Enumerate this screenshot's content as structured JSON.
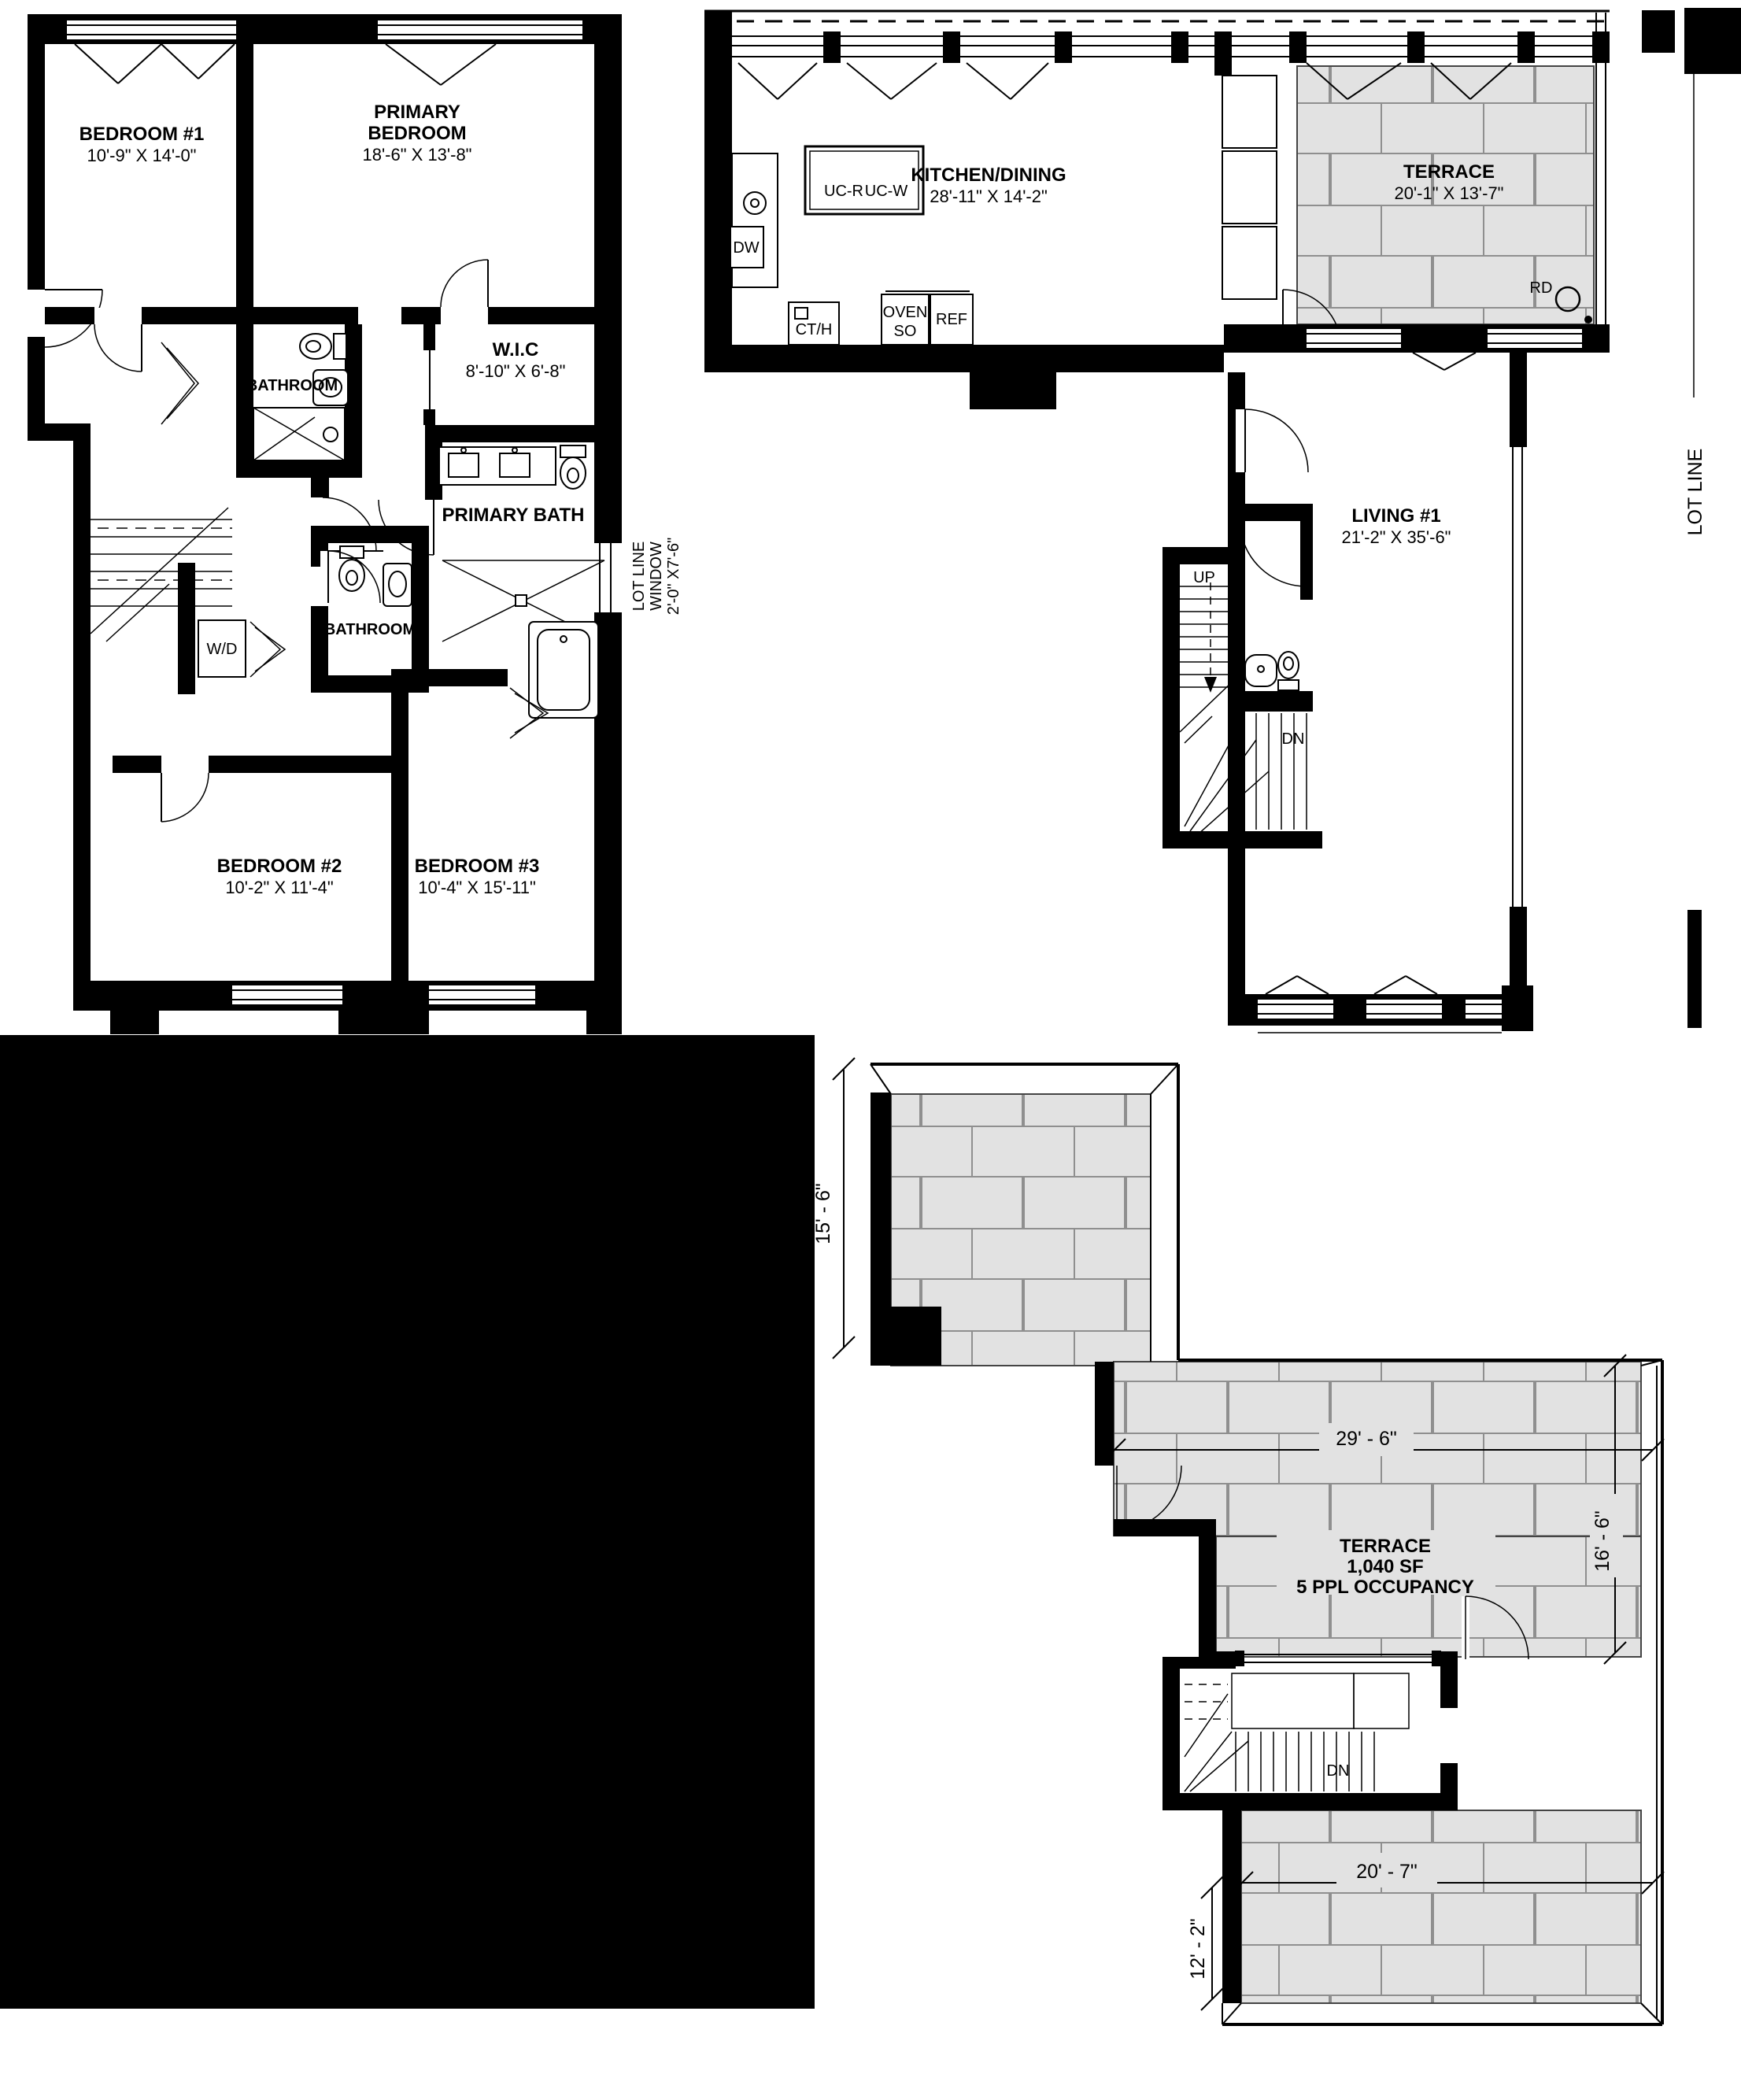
{
  "drawing_type": "residential floor plans, three sheets: bedroom level, main level, roof terrace",
  "colors": {
    "wall": "#000000",
    "tile_fill": "#e2e2e2",
    "tile_joint": "#8f8f8f",
    "background": "#ffffff"
  },
  "bedroom_level": {
    "bedroom1": {
      "name": "BEDROOM #1",
      "dims": "10'-9\" X 14'-0\""
    },
    "primary_bedroom": {
      "line1": "PRIMARY",
      "line2": "BEDROOM",
      "dims": "18'-6\" X 13'-8\""
    },
    "bathroom_upper": {
      "name": "BATHROOM"
    },
    "wic": {
      "name": "W.I.C",
      "dims": "8'-10\" X 6'-8\""
    },
    "primary_bath": {
      "name": "PRIMARY BATH"
    },
    "lot_line_window": {
      "line1": "LOT LINE",
      "line2": "WINDOW",
      "line3": "2'-0\" X7'-6\""
    },
    "wd": {
      "label": "W/D"
    },
    "bathroom_lower": {
      "name": "BATHROOM"
    },
    "bedroom2": {
      "name": "BEDROOM #2",
      "dims": "10'-2\" X 11'-4\""
    },
    "bedroom3": {
      "name": "BEDROOM #3",
      "dims": "10'-4\" X 15'-11\""
    }
  },
  "main_level": {
    "kitchen": {
      "name": "KITCHEN/DINING",
      "dims": "28'-11\" X 14'-2\""
    },
    "island": {
      "label1": "UC-R",
      "label2": "UC-W"
    },
    "dw": "DW",
    "cth": "CT/H",
    "oven_line1": "OVEN",
    "oven_line2": "SO",
    "ref": "REF",
    "terrace": {
      "name": "TERRACE",
      "dims": "20'-1\" X 13'-7\""
    },
    "rd": "RD",
    "living": {
      "name": "LIVING #1",
      "dims": "21'-2\" X 35'-6\""
    },
    "up": "UP",
    "dn": "DN",
    "lot_line": "LOT LINE"
  },
  "roof_level": {
    "terrace": {
      "name": "TERRACE",
      "area": "1,040 SF",
      "occupancy": "5 PPL OCCUPANCY"
    },
    "dn": "DN",
    "dims": {
      "left": "15' - 6\"",
      "top": "29' - 6\"",
      "right": "16' - 6\"",
      "bottom": "20' - 7\"",
      "bottom_left": "12' - 2\""
    }
  }
}
